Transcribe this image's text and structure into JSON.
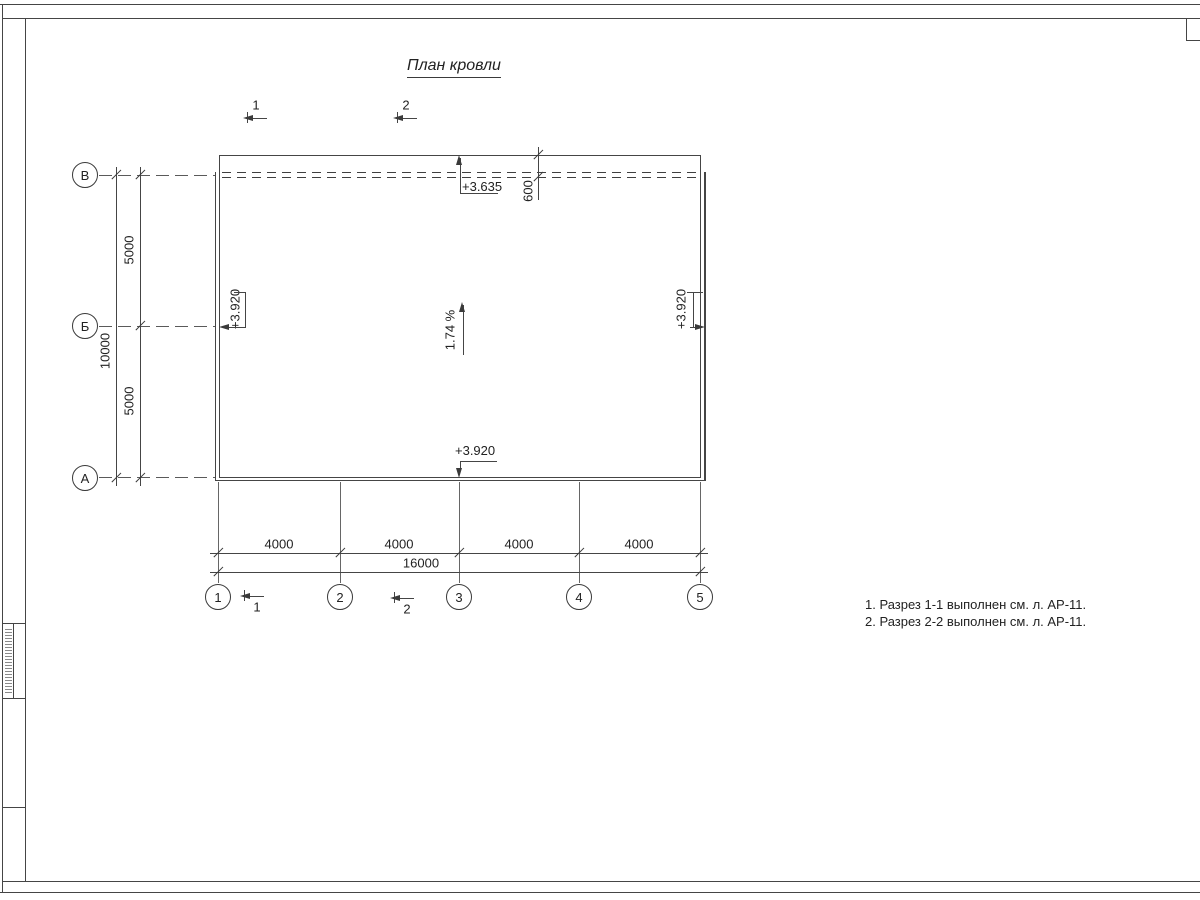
{
  "drawing": {
    "title": "План кровли",
    "row_axes": [
      "В",
      "Б",
      "А"
    ],
    "col_axes": [
      "1",
      "2",
      "3",
      "4",
      "5"
    ],
    "dims_left": {
      "overall": "10000",
      "segments": [
        "5000",
        "5000"
      ]
    },
    "dims_bottom": {
      "overall": "16000",
      "segments": [
        "4000",
        "4000",
        "4000",
        "4000"
      ]
    },
    "parapet_offset": "600",
    "elevations": {
      "top": "+3.635",
      "left": "+3.920",
      "right": "+3.920",
      "bottom": "+3.920"
    },
    "slope": "1.74 %",
    "sections": {
      "top": [
        "1",
        "2"
      ],
      "bottom": [
        "1",
        "2"
      ]
    },
    "notes": [
      "1. Разрез 1-1 выполнен см. л. АР-11.",
      "2. Разрез 2-2 выполнен см. л. АР-11."
    ],
    "colors": {
      "line": "#454545",
      "text": "#222222",
      "background": "#ffffff"
    }
  }
}
